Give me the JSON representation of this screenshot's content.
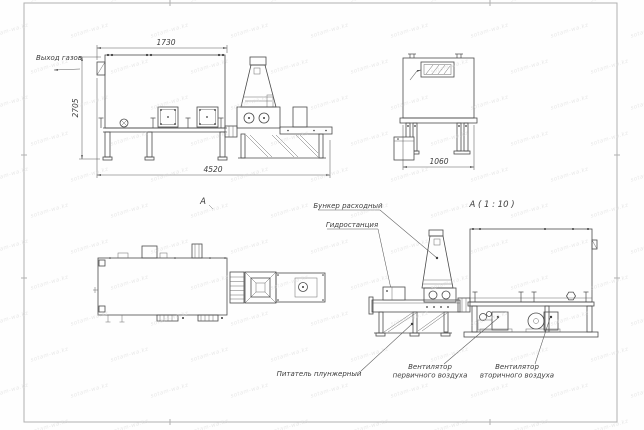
{
  "watermark": {
    "text": "sotam-wa.kz",
    "color": "#d6d6d6"
  },
  "colors": {
    "line": "#4a4a4a",
    "dim": "#5a5a5a",
    "text": "#3c3c3c",
    "frame": "#b0b0b0",
    "bg": "#ffffff"
  },
  "side_view": {
    "dim_top": "1730",
    "dim_height": "2705",
    "dim_length": "4520",
    "gas_outlet_label": "Выход газов"
  },
  "end_view": {
    "dim_width": "1060"
  },
  "plan_view": {
    "title": "A"
  },
  "detail_view": {
    "title": "A ( 1 : 10 )",
    "hopper_label": "Бункер расходный",
    "hydro_label": "Гидростанция",
    "feeder_label": "Питатель плунжерный",
    "fan_primary_label_1": "Вентилятор",
    "fan_primary_label_2": "первичного воздуха",
    "fan_secondary_label_1": "Вентилятор",
    "fan_secondary_label_2": "вторичного воздуха"
  }
}
